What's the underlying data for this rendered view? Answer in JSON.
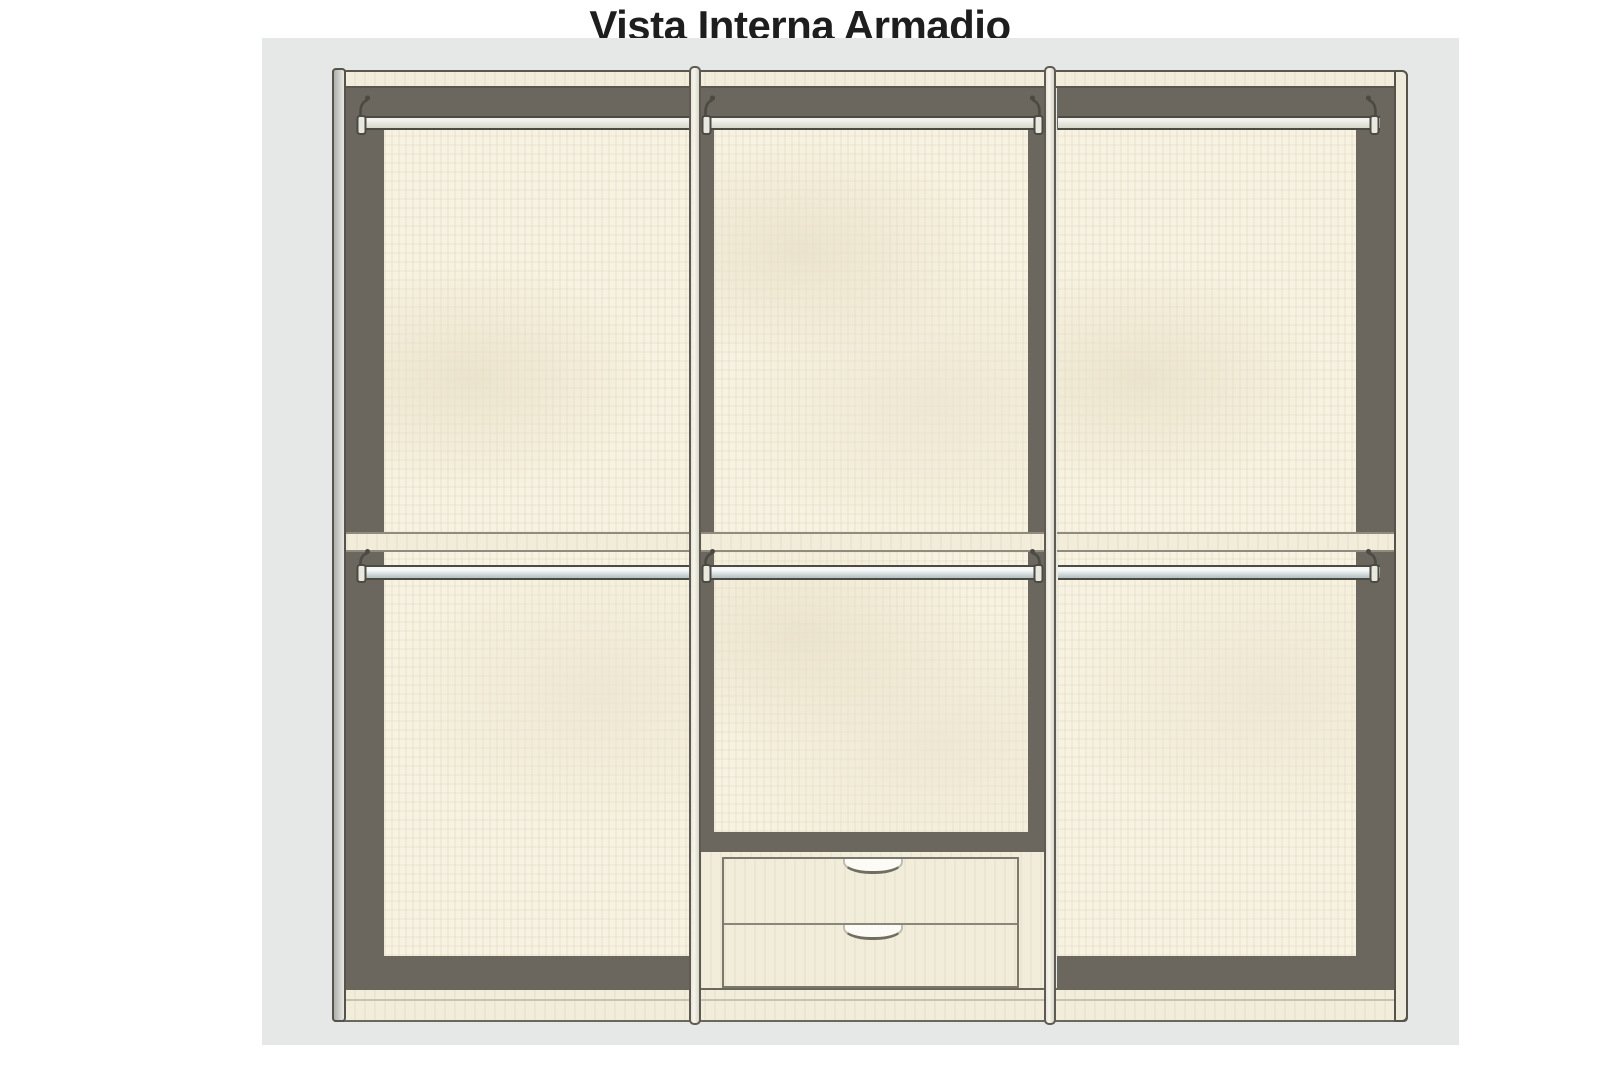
{
  "title": "Vista Interna Armadio",
  "diagram": {
    "type": "wardrobe-internal-elevation",
    "sections": [
      {
        "name": "left",
        "top_hanging_rail": true,
        "middle_shelf": true,
        "lower_hanging_rail": true,
        "drawers": 0
      },
      {
        "name": "center",
        "top_hanging_rail": true,
        "middle_shelf": true,
        "lower_hanging_rail": true,
        "drawers": 2
      },
      {
        "name": "right",
        "top_hanging_rail": true,
        "middle_shelf": true,
        "lower_hanging_rail": true,
        "drawers": 0
      }
    ],
    "drawer_count_total": 2,
    "divider_count": 2
  },
  "colors": {
    "backdrop": "#e6e8e7",
    "frame": "#6b675e",
    "panel": "#f7f2e1",
    "surface": "#f1edda",
    "outline": "#5a574d",
    "metal": "#4b4a43",
    "title": "#1e1e1e"
  }
}
